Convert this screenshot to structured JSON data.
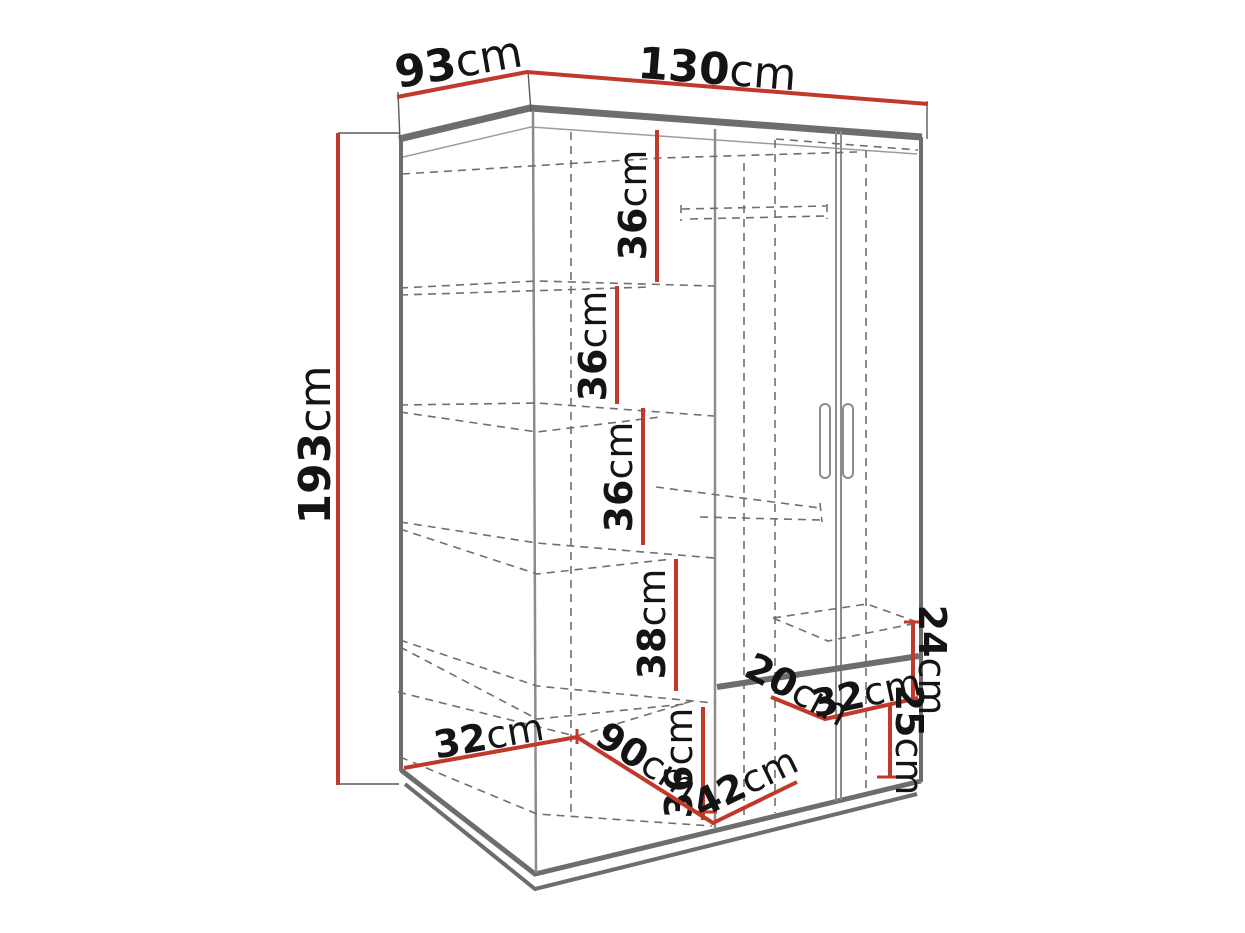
{
  "diagram": {
    "title": "Corner wardrobe dimension diagram",
    "unit_default": "cm",
    "colors": {
      "dimension": "#c0392b",
      "structure": "#6d6d6d",
      "dashed": "#6f6f6f",
      "text": "#141414"
    },
    "dimensions": {
      "d93": {
        "value": "93",
        "unit": "cm"
      },
      "d130": {
        "value": "130",
        "unit": "cm"
      },
      "d193": {
        "value": "193",
        "unit": "cm"
      },
      "s36_1": {
        "value": "36",
        "unit": "cm"
      },
      "s36_2": {
        "value": "36",
        "unit": "cm"
      },
      "s36_3": {
        "value": "36",
        "unit": "cm"
      },
      "s38": {
        "value": "38",
        "unit": "cm"
      },
      "s36_4": {
        "value": "36",
        "unit": "cm"
      },
      "f32": {
        "value": "32",
        "unit": "cm"
      },
      "f90": {
        "value": "90",
        "unit": "cm"
      },
      "f42": {
        "value": "42",
        "unit": "cm"
      },
      "r20": {
        "value": "20",
        "unit": "cm"
      },
      "r32": {
        "value": "32",
        "unit": "cm"
      },
      "r24": {
        "value": "24",
        "unit": "cm"
      },
      "r25": {
        "value": "25",
        "unit": "cm"
      }
    }
  }
}
